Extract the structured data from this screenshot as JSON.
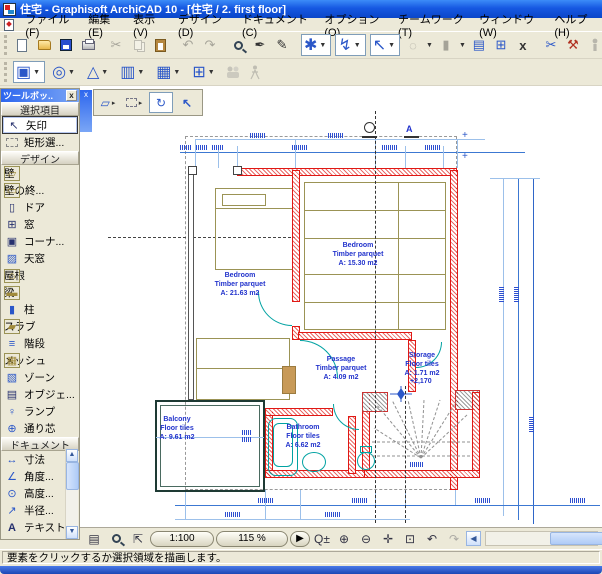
{
  "window": {
    "title": "住宅 - Graphisoft ArchiCAD 10 - [住宅 / 2. first floor]"
  },
  "menu": {
    "items": [
      "ファイル(F)",
      "編集(E)",
      "表示(V)",
      "デザイン(D)",
      "ドキュメント(C)",
      "オプション(O)",
      "チームワーク(T)",
      "ウィンドウ(W)",
      "ヘルプ(H)"
    ]
  },
  "toolbar_icons": [
    "new",
    "open",
    "save",
    "print",
    "cut",
    "copy",
    "paste",
    "undo",
    "redo",
    "find-select",
    "pickup-parameters",
    "inject-parameters",
    "arrow-snap-combo",
    "cursor-snap-combo",
    "measure-combo",
    "dotted-circle-combo",
    "column-combo",
    "layer-settings",
    "grid-view",
    "detach",
    "3d-cutaway",
    "demolish",
    "show-person",
    "corner-tool",
    "arc-tool"
  ],
  "toolbox": {
    "title": "ツールボッ..",
    "sections": [
      {
        "label": "選択項目",
        "tools": [
          {
            "label": "矢印",
            "selected": true
          },
          {
            "label": "矩形選..."
          }
        ]
      },
      {
        "label": "デザイン",
        "tools": [
          {
            "label": "壁"
          },
          {
            "label": "壁の終..."
          },
          {
            "label": "ドア"
          },
          {
            "label": "窓"
          },
          {
            "label": "コーナ..."
          },
          {
            "label": "天窓"
          },
          {
            "label": "屋根"
          },
          {
            "label": "梁"
          },
          {
            "label": "柱"
          },
          {
            "label": "スラブ"
          },
          {
            "label": "階段"
          },
          {
            "label": "メッシュ"
          },
          {
            "label": "ゾーン"
          },
          {
            "label": "オブジェ..."
          },
          {
            "label": "ランプ"
          },
          {
            "label": "通り芯"
          }
        ]
      },
      {
        "label": "ドキュメント",
        "tools": [
          {
            "label": "寸法"
          },
          {
            "label": "角度..."
          },
          {
            "label": "高度..."
          },
          {
            "label": "半径..."
          },
          {
            "label": "テキスト"
          }
        ]
      }
    ]
  },
  "plan": {
    "rooms": [
      {
        "name": "Bedroom",
        "finish": "Timber parquet",
        "area": "A: 21.63 m2"
      },
      {
        "name": "Bedroom",
        "finish": "Timber parquet",
        "area": "A: 15.30 m2"
      },
      {
        "name": "Passage",
        "finish": "Timber parquet",
        "area": "A: 4.09 m2"
      },
      {
        "name": "Storage",
        "finish": "Floor tiles",
        "area": "A: 1.71 m2"
      },
      {
        "name": "Balcony",
        "finish": "Floor tiles",
        "area": "A: 9.61 m2"
      },
      {
        "name": "Bathroom",
        "finish": "Floor tiles",
        "area": "A: 6.62 m2"
      }
    ],
    "level_annotation": "+2,170",
    "section_marker": "A"
  },
  "canvas_bar": {
    "scale": "1:100",
    "zoom": "115 %"
  },
  "status_bar": {
    "message": "要素をクリックするか選択領域を描画します。"
  },
  "colors": {
    "wall_red": "#e01814",
    "fixture_teal": "#00a2a2",
    "dimension_blue": "#3c78d2",
    "furniture_tan": "#9b9355",
    "titlebar_blue": "#1658e2"
  }
}
